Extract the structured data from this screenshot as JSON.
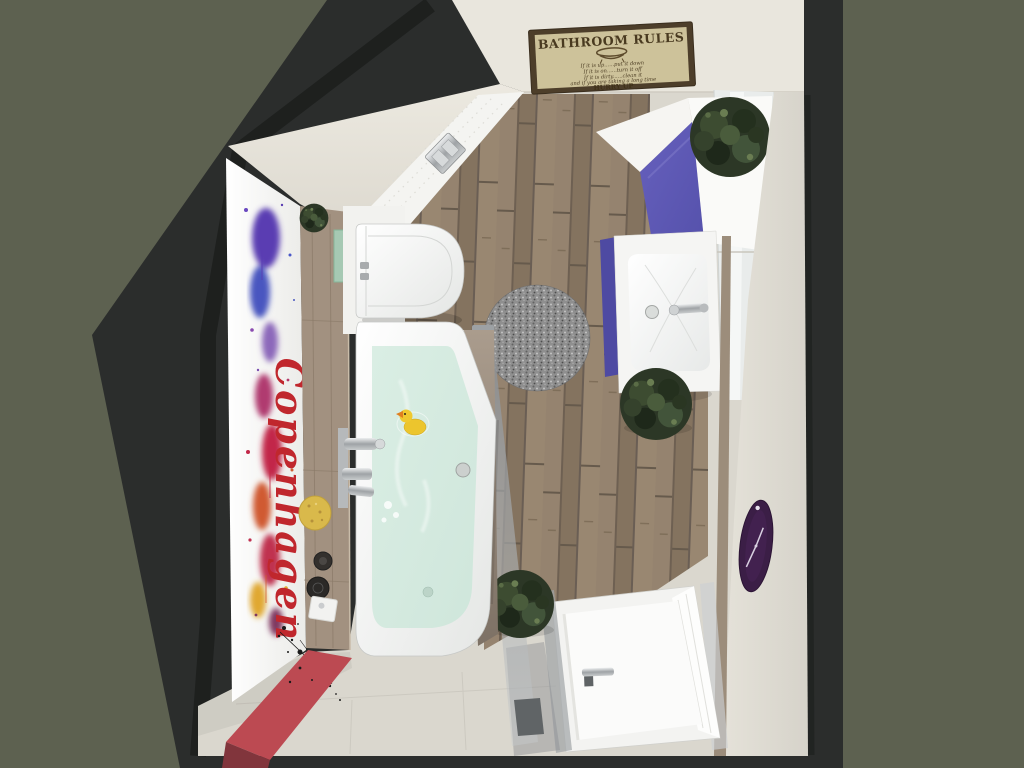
{
  "meta": {
    "alt": "3D top-down rendering of a bathroom with bathtub, toilet, vanity, shower and decor"
  },
  "sign": {
    "title": "BATHROOM RULES",
    "lines": [
      "If it is up......put it down",
      "If it is on......turn it off",
      "If it is dirty......clean it",
      "and if you are taking a long time"
    ],
    "footer": "HURRY UP"
  },
  "wall_art": {
    "text": "Copenhagen"
  },
  "colors": {
    "background": "#5d6150",
    "wall_frame": "#2b2d2c",
    "ceiling_cream": "#e9e6dd",
    "floor_tile": "#dad7ce",
    "wood_floor": "#8c7b6a",
    "wood_ledge": "#a29180",
    "tub_white": "#fdfdfd",
    "water": "#cfe6db",
    "cabinet_purple": "#5551ab",
    "vanity_purple": "#4e4aa2",
    "clock_purple": "#3b1e46",
    "bench_red": "#bc4a52",
    "rug_gray": "#8f8f8f",
    "sign_parchment": "#cdc29a",
    "sign_frame": "#4d3e2a",
    "duck_yellow": "#ecc52d",
    "sponge_yellow": "#d9b94b",
    "plant_green": "#2c3726",
    "art_red": "#c0272d"
  }
}
